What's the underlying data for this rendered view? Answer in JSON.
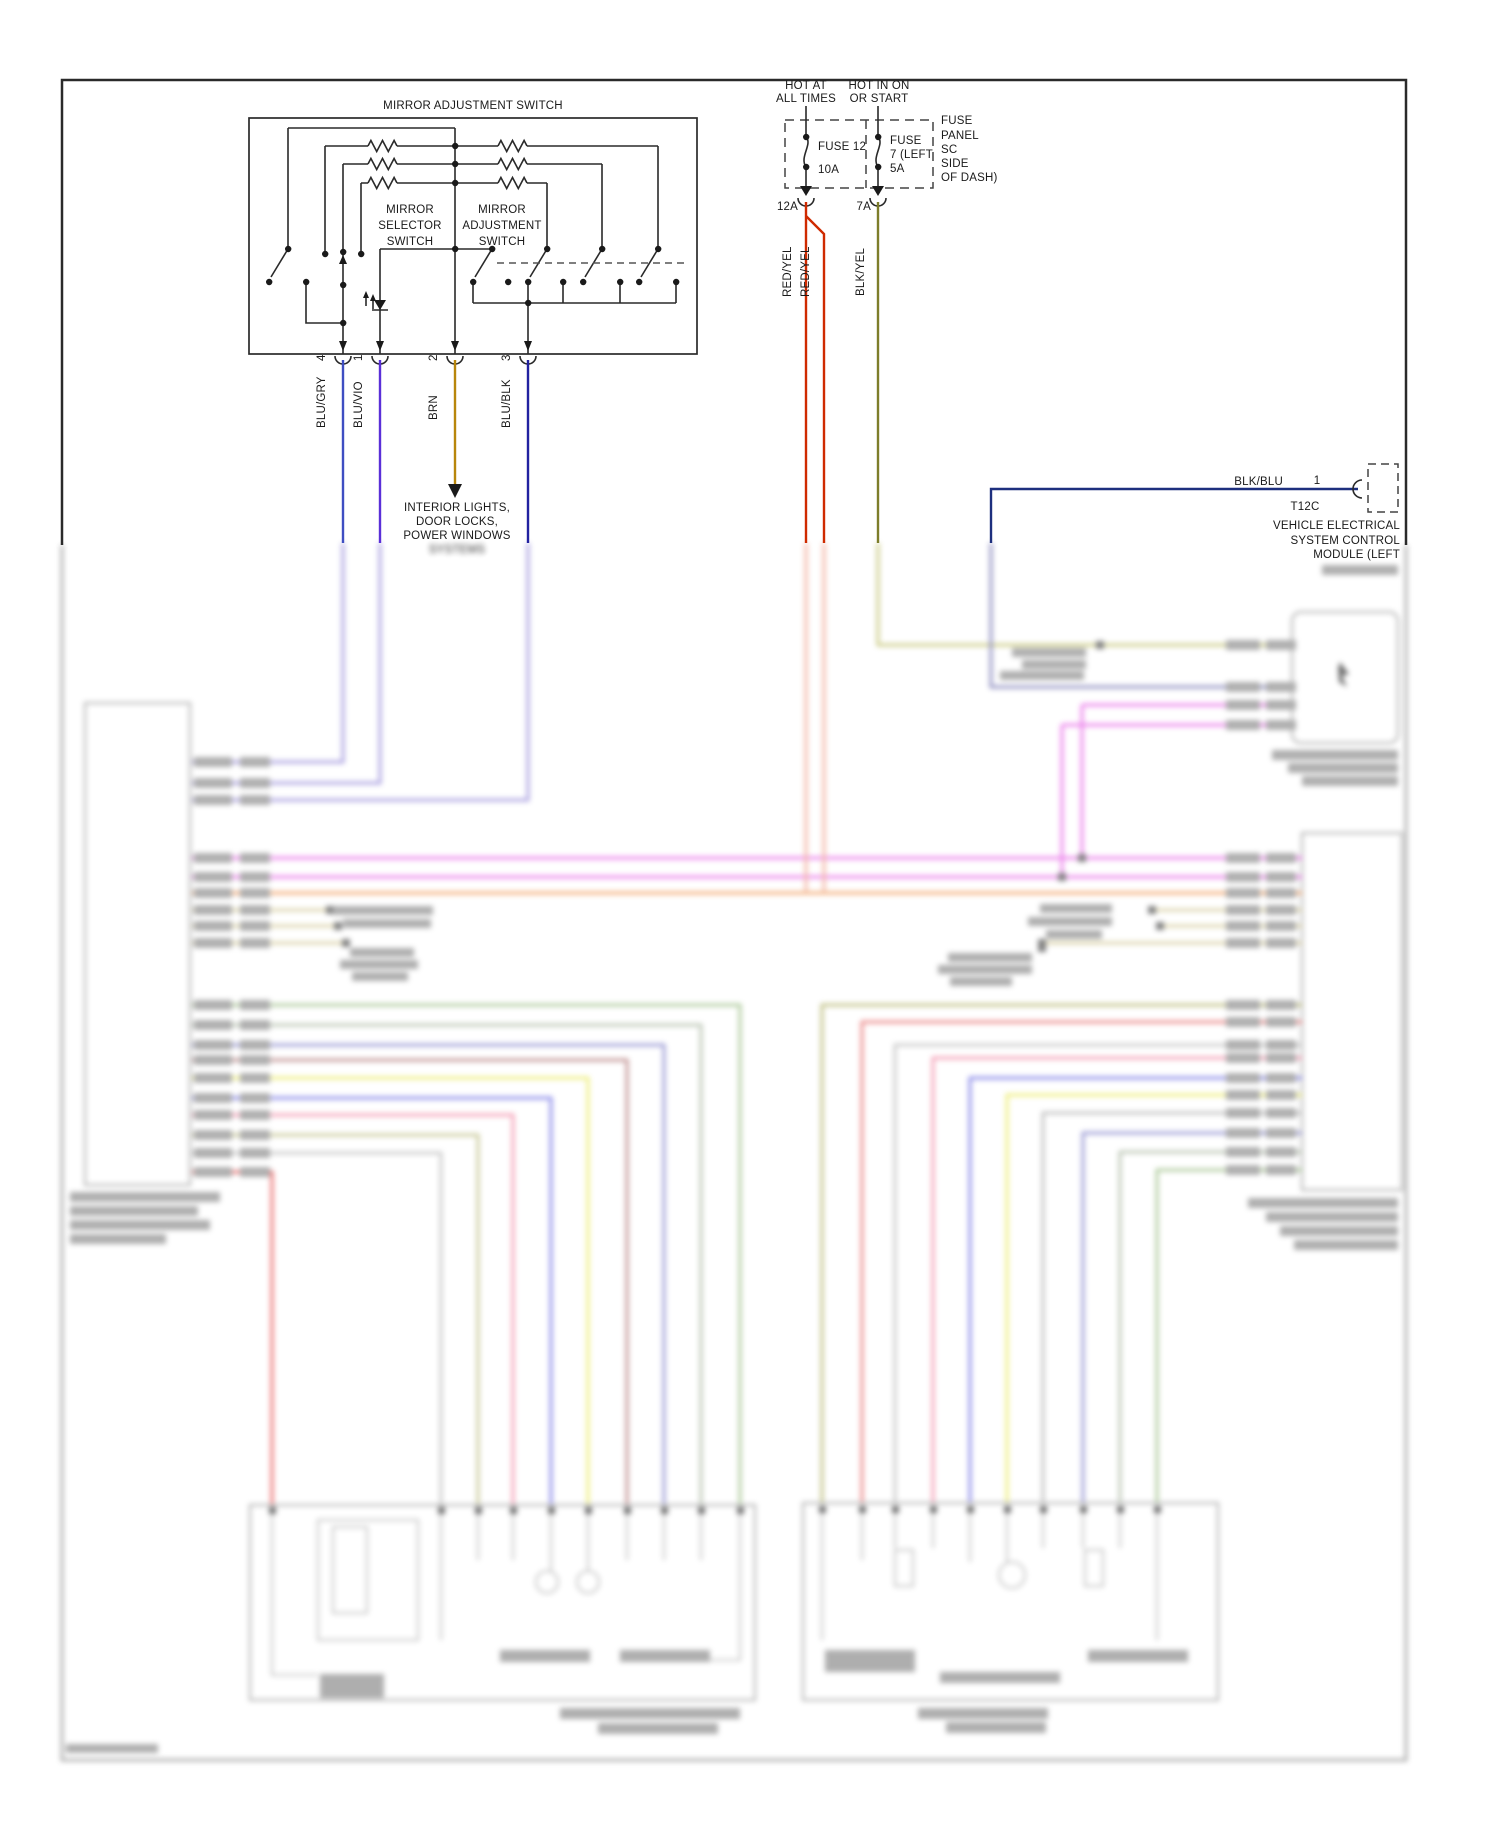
{
  "page": {
    "background": "#ffffff"
  },
  "colors": {
    "blu_gry": "#3f4ec2",
    "blu_vio": "#5a2fd8",
    "brn": "#b8860b",
    "blu_blk": "#2222a0",
    "red_yel": "#cf2a00",
    "blk_yel": "#7d7d2a",
    "blk_blu": "#1d2f7e",
    "line": "#1a1a1a"
  },
  "switch_box": {
    "title": "MIRROR ADJUSTMENT SWITCH",
    "selector_lines": [
      "MIRROR",
      "SELECTOR",
      "SWITCH"
    ],
    "adjustment_lines": [
      "MIRROR",
      "ADJUSTMENT",
      "SWITCH"
    ],
    "pins": [
      {
        "number": "4",
        "wire": "BLU/GRY"
      },
      {
        "number": "1",
        "wire": "BLU/VIO"
      },
      {
        "number": "2",
        "wire": "BRN"
      },
      {
        "number": "3",
        "wire": "BLU/BLK"
      }
    ]
  },
  "brn_note": {
    "lines": [
      "INTERIOR LIGHTS,",
      "DOOR LOCKS,",
      "POWER WINDOWS",
      "SYSTEMS"
    ]
  },
  "fuse_panel": {
    "hot_left": [
      "HOT AT",
      "ALL TIMES"
    ],
    "hot_right": [
      "HOT IN ON",
      "OR START"
    ],
    "fuse12": {
      "name": "FUSE 12",
      "rating": "10A",
      "connector": "12A",
      "wire": "RED/YEL",
      "wire2": "RED/YEL"
    },
    "fuse7": {
      "name_lines": [
        "FUSE",
        "7 (LEFT",
        "5A"
      ],
      "connector": "7A",
      "wire": "BLK/YEL"
    },
    "panel_lines": [
      "FUSE",
      "PANEL",
      "SC",
      "SIDE",
      "OF DASH)"
    ]
  },
  "vescm": {
    "wire": "BLK/BLU",
    "pin": "1",
    "connector": "T12C",
    "name_lines": [
      "VEHICLE ELECTRICAL",
      "SYSTEM CONTROL",
      "MODULE (LEFT"
    ]
  }
}
